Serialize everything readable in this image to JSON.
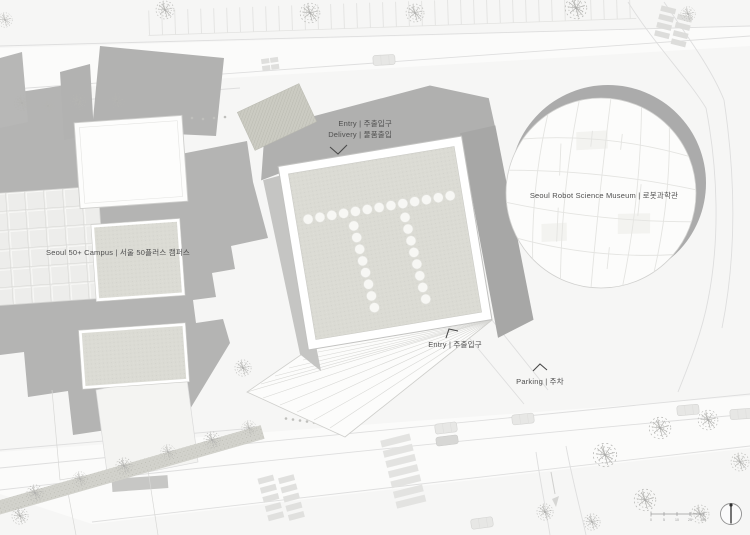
{
  "labels": {
    "entry_top": "Entry | 주출입구",
    "delivery_top": "Delivery | 물품출입",
    "campus": "Seoul 50+ Campus | 서울 50플러스 캠퍼스",
    "museum": "Seoul Robot Science Museum | 로봇과학관",
    "entry_plaza": "Entry | 주출입구",
    "parking": "Parking | 주차"
  },
  "scale_bar": {
    "ticks": [
      "0",
      "5",
      "10",
      "25",
      "50"
    ]
  },
  "colors": {
    "background": "#f6f6f5",
    "building_gray": "#b3b3b3",
    "roof_tint": "#dcdcd5",
    "line_gray": "#dedede",
    "text_gray": "#4f4f4f"
  }
}
